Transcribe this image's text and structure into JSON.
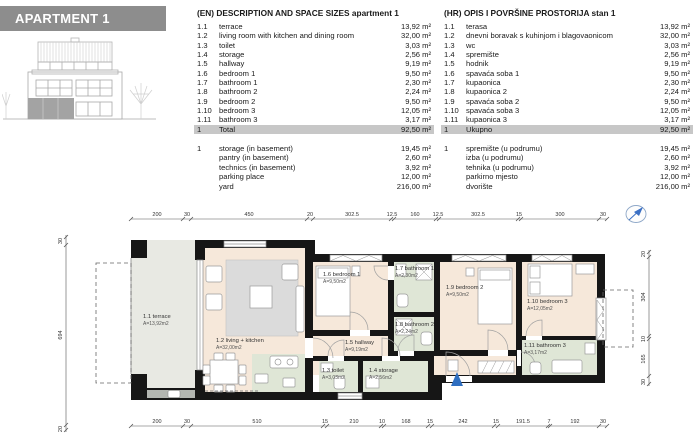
{
  "header": {
    "title": "APARTMENT 1"
  },
  "tables": {
    "en": {
      "title": "(EN) DESCRIPTION AND SPACE SIZES apartment 1",
      "rows": [
        {
          "code": "1.1",
          "label": "terrace",
          "area": "13,92 m²"
        },
        {
          "code": "1.2",
          "label": "living room with kitchen and dining room",
          "area": "32,00 m²"
        },
        {
          "code": "1.3",
          "label": "toilet",
          "area": "3,03 m²"
        },
        {
          "code": "1.4",
          "label": "storage",
          "area": "2,56 m²"
        },
        {
          "code": "1.5",
          "label": "hallway",
          "area": "9,19 m²"
        },
        {
          "code": "1.6",
          "label": "bedroom 1",
          "area": "9,50 m²"
        },
        {
          "code": "1.7",
          "label": "bathroom 1",
          "area": "2,30 m²"
        },
        {
          "code": "1.8",
          "label": "bathroom 2",
          "area": "2,24 m²"
        },
        {
          "code": "1.9",
          "label": "bedroom 2",
          "area": "9,50 m²"
        },
        {
          "code": "1.10",
          "label": "bedroom 3",
          "area": "12,05 m²"
        },
        {
          "code": "1.11",
          "label": "bathroom 3",
          "area": "3,17 m²"
        }
      ],
      "total": {
        "code": "1",
        "label": "Total",
        "area": "92,50 m²"
      },
      "extras": [
        {
          "code": "1",
          "label": "storage (in basement)",
          "area": "19,45 m²"
        },
        {
          "code": "",
          "label": "pantry (in basement)",
          "area": "2,60 m²"
        },
        {
          "code": "",
          "label": "technics (in basement)",
          "area": "3,92 m²"
        },
        {
          "code": "",
          "label": "parking place",
          "area": "12,00 m²"
        },
        {
          "code": "",
          "label": "yard",
          "area": "216,00 m²"
        }
      ]
    },
    "hr": {
      "title": "(HR) OPIS I POVRŠINE PROSTORIJA stan 1",
      "rows": [
        {
          "code": "1.1",
          "label": "terasa",
          "area": "13,92 m²"
        },
        {
          "code": "1.2",
          "label": "dnevni boravak s kuhinjom i blagovaonicom",
          "area": "32,00 m²"
        },
        {
          "code": "1.3",
          "label": "wc",
          "area": "3,03 m²"
        },
        {
          "code": "1.4",
          "label": "spremište",
          "area": "2,56 m²"
        },
        {
          "code": "1.5",
          "label": "hodnik",
          "area": "9,19 m²"
        },
        {
          "code": "1.6",
          "label": "spavaća soba 1",
          "area": "9,50 m²"
        },
        {
          "code": "1.7",
          "label": "kupaonica",
          "area": "2,30 m²"
        },
        {
          "code": "1.8",
          "label": "kupaonica 2",
          "area": "2,24 m²"
        },
        {
          "code": "1.9",
          "label": "spavaća soba 2",
          "area": "9,50 m²"
        },
        {
          "code": "1.10",
          "label": "spavaća soba 3",
          "area": "12,05 m²"
        },
        {
          "code": "1.11",
          "label": "kupaonica 3",
          "area": "3,17 m²"
        }
      ],
      "total": {
        "code": "1",
        "label": "Ukupno",
        "area": "92,50 m²"
      },
      "extras": [
        {
          "code": "1",
          "label": "spremište (u podrumu)",
          "area": "19,45 m²"
        },
        {
          "code": "",
          "label": "izba (u podrumu)",
          "area": "2,60 m²"
        },
        {
          "code": "",
          "label": "tehnika (u podrumu)",
          "area": "3,92 m²"
        },
        {
          "code": "",
          "label": "parkirno mjesto",
          "area": "12,00 m²"
        },
        {
          "code": "",
          "label": "dvorište",
          "area": "216,00 m²"
        }
      ]
    }
  },
  "plan": {
    "rooms": {
      "terrace": {
        "name": "1.1 terrace",
        "area": "A=13,92m2"
      },
      "living": {
        "name": "1.2 living + kitchen",
        "area": "A=32,00m2"
      },
      "toilet": {
        "name": "1.3 toilet",
        "area": "A=3,03m2"
      },
      "storage": {
        "name": "1.4 storage",
        "area": "A=2,56m2"
      },
      "hallway": {
        "name": "1.5 hallway",
        "area": "A=9,19m2"
      },
      "bedroom1": {
        "name": "1.6 bedroom 1",
        "area": "A=9,50m2"
      },
      "bathroom1": {
        "name": "1.7 bathroom 1",
        "area": "A=2,30m2"
      },
      "bathroom2": {
        "name": "1.8 bathroom 2",
        "area": "A=2,24m2"
      },
      "bedroom2": {
        "name": "1.9 bedroom 2",
        "area": "A=9,50m2"
      },
      "bedroom3": {
        "name": "1.10 bedroom 3",
        "area": "A=12,05m2"
      },
      "bathroom3": {
        "name": "1.11 bathroom 3",
        "area": "A=3,17m2"
      }
    },
    "dims": {
      "top": [
        "200",
        "30",
        "450",
        "20",
        "302.5",
        "12.5",
        "160",
        "12.5",
        "302.5",
        "15",
        "300",
        "30"
      ],
      "bottom": [
        "200",
        "30",
        "510",
        "15",
        "210",
        "10",
        "168",
        "15",
        "242",
        "15",
        "191.5",
        "7",
        "192",
        "30"
      ],
      "left": [
        "30",
        "694",
        "20"
      ],
      "right": [
        "20",
        "304",
        "10",
        "165",
        "30"
      ]
    },
    "colors": {
      "wall": "#161616",
      "floor": "#f6e8da",
      "wet": "#dfe6d6",
      "terrace": "#e8e9e3",
      "accent": "#2f6fc1"
    }
  }
}
